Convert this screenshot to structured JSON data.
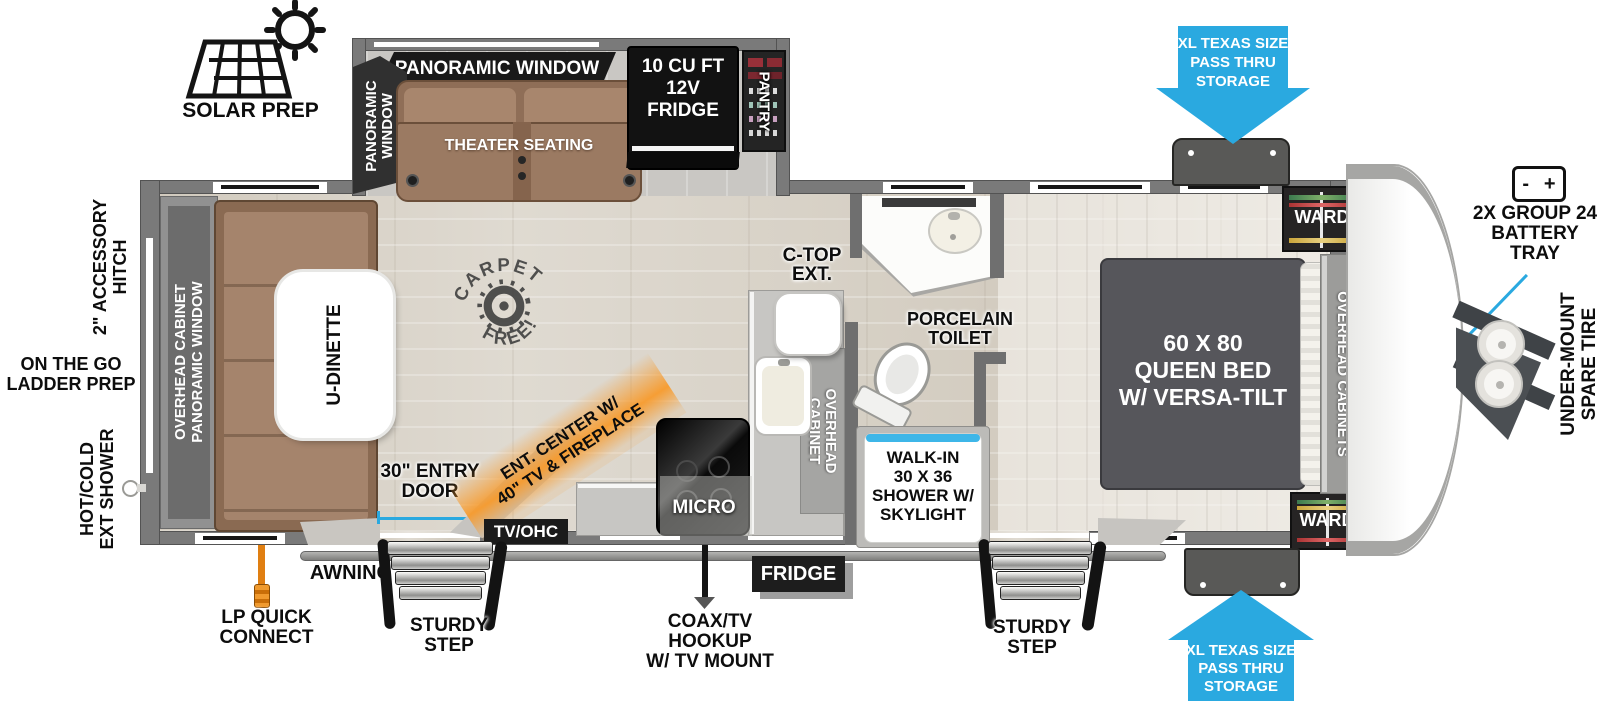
{
  "colors": {
    "accent_blue": "#2aa9e0",
    "orange": "#f8992b",
    "wall_gray": "#7a7a7a",
    "label_black": "#141414",
    "sofa_brown": "#9b7a62"
  },
  "exterior": {
    "solar_prep": "SOLAR PREP",
    "pass_thru": [
      "XL TEXAS SIZE",
      "PASS THRU",
      "STORAGE"
    ],
    "battery": {
      "minus": "-",
      "plus": "+",
      "label": [
        "2X GROUP 24",
        "BATTERY",
        "TRAY"
      ]
    },
    "under_mount": [
      "UNDER-MOUNT",
      "SPARE TIRE"
    ],
    "accessory_hitch": [
      "2\" ACCESSORY",
      "HITCH"
    ],
    "ladder_prep": [
      "ON THE GO",
      "LADDER PREP"
    ],
    "ext_shower": [
      "HOT/COLD",
      "EXT SHOWER"
    ],
    "awning": "AWNING",
    "sturdy_step": [
      "STURDY",
      "STEP"
    ],
    "lp_quick_connect": [
      "LP QUICK",
      "CONNECT"
    ],
    "coax": [
      "COAX/TV HOOKUP",
      "W/ TV MOUNT"
    ],
    "fridge_tag": "FRIDGE"
  },
  "slide_out": {
    "panoramic_window": "PANORAMIC WINDOW",
    "panoramic_window_lines": [
      "PANORAMIC",
      "WINDOW"
    ],
    "theater_seating": "THEATER SEATING",
    "fridge": [
      "10 CU FT",
      "12V",
      "FRIDGE"
    ],
    "pantry": "PANTRY"
  },
  "living": {
    "overhead_band": [
      "OVERHEAD CABINET",
      "PANORAMIC WINDOW"
    ],
    "dinette": "U-DINETTE",
    "carpet_stamp": [
      "CARPET",
      "FREE!"
    ],
    "entry_door": [
      "30\" ENTRY",
      "DOOR"
    ],
    "ent_center": [
      "ENT. CENTER W/",
      "40\" TV & FIREPLACE"
    ],
    "tv_ohc": "TV/OHC"
  },
  "kitchen": {
    "micro": "MICRO",
    "ctop_ext": [
      "C-TOP",
      "EXT."
    ],
    "overhead_cabinet": [
      "OVERHEAD",
      "CABINET"
    ]
  },
  "bathroom": {
    "toilet": [
      "PORCELAIN",
      "TOILET"
    ],
    "shower": [
      "WALK-IN",
      "30 X 36",
      "SHOWER W/",
      "SKYLIGHT"
    ]
  },
  "bedroom": {
    "bed": [
      "60 X 80",
      "QUEEN BED",
      "W/ VERSA-TILT"
    ],
    "ward": "WARD",
    "overhead_cabinets": "OVERHEAD CABINETS"
  }
}
